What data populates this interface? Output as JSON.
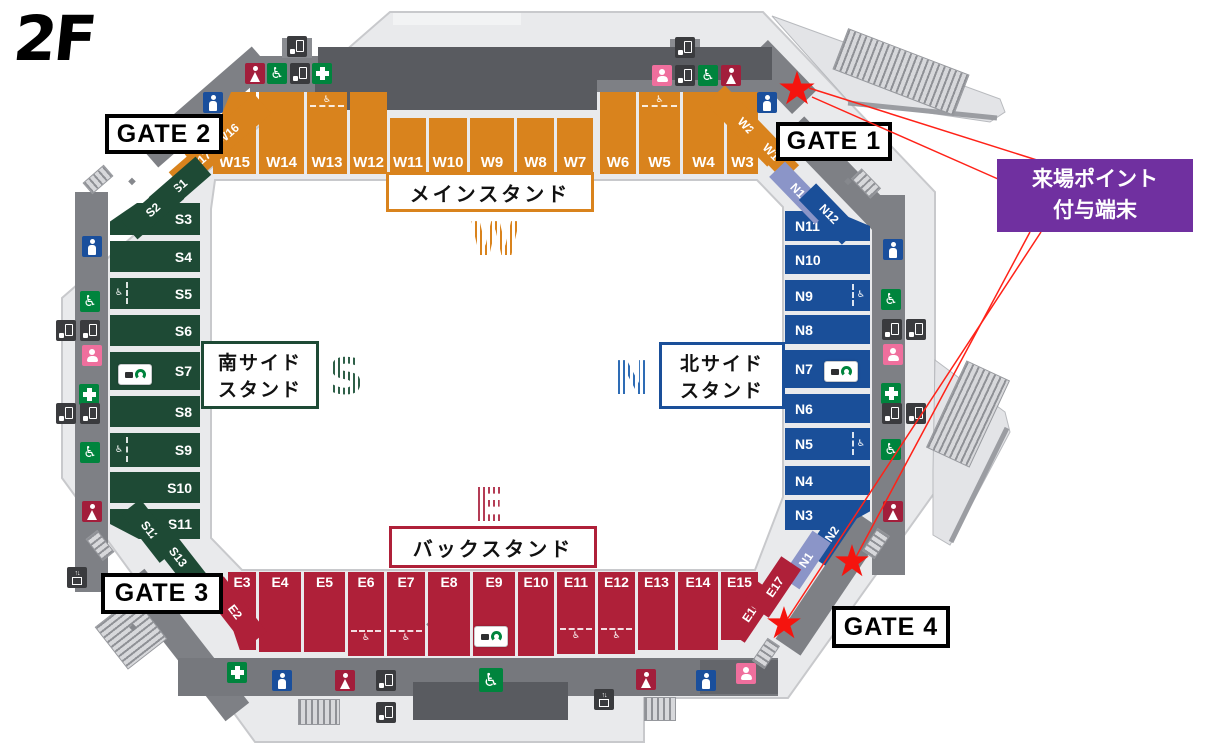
{
  "floor_label": "2F",
  "gates": {
    "gate1": "GATE 1",
    "gate2": "GATE 2",
    "gate3": "GATE 3",
    "gate4": "GATE 4"
  },
  "terminal": {
    "line1": "来場ポイント",
    "line2": "付与端末",
    "bg_color": "#7030A0"
  },
  "stands": {
    "main": {
      "name": "メインスタンド",
      "letter": "W",
      "color": "#D9831D",
      "sections": [
        "W1",
        "W2",
        "W3",
        "W4",
        "W5",
        "W6",
        "W7",
        "W8",
        "W9",
        "W10",
        "W11",
        "W12",
        "W13",
        "W14",
        "W15",
        "W16",
        "W17"
      ]
    },
    "back": {
      "name": "バックスタンド",
      "letter": "E",
      "color": "#AF2039",
      "sections": [
        "E2",
        "E3",
        "E4",
        "E5",
        "E6",
        "E7",
        "E8",
        "E9",
        "E10",
        "E11",
        "E12",
        "E13",
        "E14",
        "E15",
        "E16",
        "E17"
      ]
    },
    "south": {
      "name_line1": "南サイド",
      "name_line2": "スタンド",
      "letter": "S",
      "color": "#1E4A35",
      "sections": [
        "S1",
        "S2",
        "S3",
        "S4",
        "S5",
        "S6",
        "S7",
        "S8",
        "S9",
        "S10",
        "S11",
        "S12",
        "S13"
      ]
    },
    "north": {
      "name_line1": "北サイド",
      "name_line2": "スタンド",
      "letter": "N",
      "color": "#1A4F99",
      "alt_color": "#8B95C8",
      "sections": [
        "N1",
        "N2",
        "N3",
        "N4",
        "N5",
        "N6",
        "N7",
        "N8",
        "N9",
        "N10",
        "N11",
        "N12",
        "N13"
      ]
    }
  },
  "icons": {
    "star": "★",
    "diamond": "◆",
    "wheelchair": "♿",
    "elevator_arrows": "↑↓"
  }
}
